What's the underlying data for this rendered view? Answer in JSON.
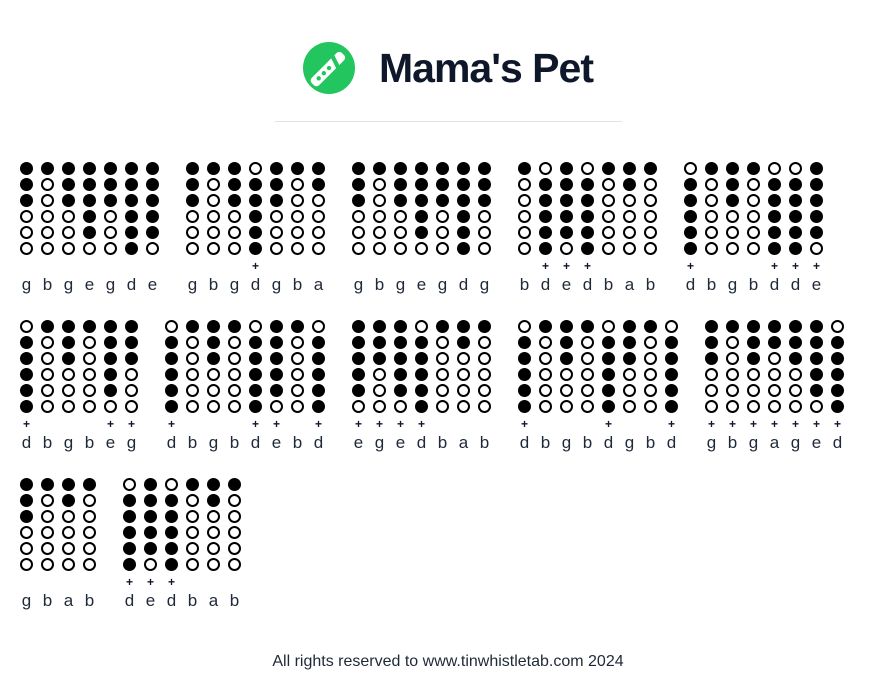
{
  "header": {
    "title": "Mama's Pet"
  },
  "icon": {
    "name": "tin-whistle-icon",
    "green": "#22c55e"
  },
  "colors": {
    "accent_green": "#22c55e",
    "ink": "#0f172a",
    "divider": "#dde3ea",
    "hole_fill": "#000000"
  },
  "footer": {
    "text": "All rights reserved to www.tinwhistletab.com 2024"
  },
  "tab": {
    "rows": [
      {
        "measures": [
          {
            "notes": [
              [
                "g",
                0,
                "111000"
              ],
              [
                "b",
                0,
                "100000"
              ],
              [
                "g",
                0,
                "111000"
              ],
              [
                "e",
                0,
                "111110"
              ],
              [
                "g",
                0,
                "111000"
              ],
              [
                "d",
                0,
                "111111"
              ],
              [
                "e",
                0,
                "111110"
              ]
            ]
          },
          {
            "notes": [
              [
                "g",
                0,
                "111000"
              ],
              [
                "b",
                0,
                "100000"
              ],
              [
                "g",
                0,
                "111000"
              ],
              [
                "d",
                1,
                "011111"
              ],
              [
                "g",
                0,
                "111000"
              ],
              [
                "b",
                0,
                "100000"
              ],
              [
                "a",
                0,
                "110000"
              ]
            ]
          },
          {
            "notes": [
              [
                "g",
                0,
                "111000"
              ],
              [
                "b",
                0,
                "100000"
              ],
              [
                "g",
                0,
                "111000"
              ],
              [
                "e",
                0,
                "111110"
              ],
              [
                "g",
                0,
                "111000"
              ],
              [
                "d",
                0,
                "111111"
              ],
              [
                "g",
                0,
                "111000"
              ]
            ]
          },
          {
            "notes": [
              [
                "b",
                0,
                "100000"
              ],
              [
                "d",
                1,
                "011111"
              ],
              [
                "e",
                1,
                "111110"
              ],
              [
                "d",
                1,
                "011111"
              ],
              [
                "b",
                0,
                "100000"
              ],
              [
                "a",
                0,
                "110000"
              ],
              [
                "b",
                0,
                "100000"
              ]
            ]
          },
          {
            "notes": [
              [
                "d",
                1,
                "011111"
              ],
              [
                "b",
                0,
                "100000"
              ],
              [
                "g",
                0,
                "111000"
              ],
              [
                "b",
                0,
                "100000"
              ],
              [
                "d",
                1,
                "011111"
              ],
              [
                "d",
                1,
                "011111"
              ],
              [
                "e",
                1,
                "111110"
              ]
            ]
          }
        ]
      },
      {
        "measures": [
          {
            "notes": [
              [
                "d",
                1,
                "011111"
              ],
              [
                "b",
                0,
                "100000"
              ],
              [
                "g",
                0,
                "111000"
              ],
              [
                "b",
                0,
                "100000"
              ],
              [
                "e",
                1,
                "111110"
              ],
              [
                "g",
                1,
                "111000"
              ]
            ]
          },
          {
            "notes": [
              [
                "d",
                1,
                "011111"
              ],
              [
                "b",
                0,
                "100000"
              ],
              [
                "g",
                0,
                "111000"
              ],
              [
                "b",
                0,
                "100000"
              ],
              [
                "d",
                1,
                "011111"
              ],
              [
                "e",
                1,
                "111110"
              ],
              [
                "b",
                0,
                "100000"
              ],
              [
                "d",
                1,
                "011111"
              ]
            ]
          },
          {
            "notes": [
              [
                "e",
                1,
                "111110"
              ],
              [
                "g",
                1,
                "111000"
              ],
              [
                "e",
                1,
                "111110"
              ],
              [
                "d",
                1,
                "011111"
              ],
              [
                "b",
                0,
                "100000"
              ],
              [
                "a",
                0,
                "110000"
              ],
              [
                "b",
                0,
                "100000"
              ]
            ]
          },
          {
            "notes": [
              [
                "d",
                1,
                "011111"
              ],
              [
                "b",
                0,
                "100000"
              ],
              [
                "g",
                0,
                "111000"
              ],
              [
                "b",
                0,
                "100000"
              ],
              [
                "d",
                1,
                "011111"
              ],
              [
                "g",
                0,
                "111000"
              ],
              [
                "b",
                0,
                "100000"
              ],
              [
                "d",
                1,
                "011111"
              ]
            ]
          },
          {
            "notes": [
              [
                "g",
                1,
                "111000"
              ],
              [
                "b",
                1,
                "100000"
              ],
              [
                "g",
                1,
                "111000"
              ],
              [
                "a",
                1,
                "110000"
              ],
              [
                "g",
                1,
                "111000"
              ],
              [
                "e",
                1,
                "111110"
              ],
              [
                "d",
                1,
                "011111"
              ]
            ]
          }
        ]
      },
      {
        "measures": [
          {
            "notes": [
              [
                "g",
                0,
                "111000"
              ],
              [
                "b",
                0,
                "100000"
              ],
              [
                "a",
                0,
                "110000"
              ],
              [
                "b",
                0,
                "100000"
              ]
            ]
          },
          {
            "notes": [
              [
                "d",
                1,
                "011111"
              ],
              [
                "e",
                1,
                "111110"
              ],
              [
                "d",
                1,
                "011111"
              ],
              [
                "b",
                0,
                "100000"
              ],
              [
                "a",
                0,
                "110000"
              ],
              [
                "b",
                0,
                "100000"
              ]
            ]
          }
        ]
      }
    ]
  }
}
